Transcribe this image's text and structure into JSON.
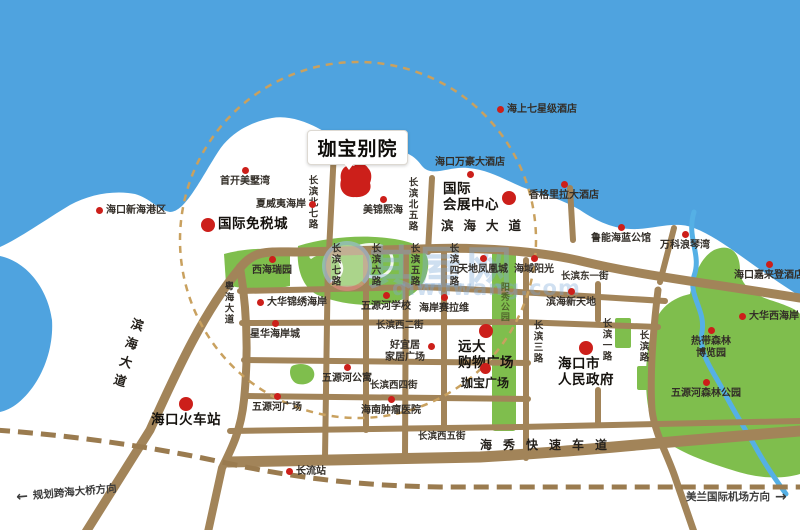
{
  "meta": {
    "map_type": "real-estate location map",
    "project": "珈宝别院"
  },
  "colors": {
    "sea": "#4FA3DF",
    "land": "#FFFFFF",
    "road": "#A28459",
    "railway": "#9A7B4F",
    "green": "#7FBE4D",
    "river": "#55B0E5",
    "marker_red": "#CC1F1A",
    "radius_dash": "#C9A15F",
    "text": "#332E28",
    "watermark": "#7DAAD7"
  },
  "title": {
    "label": "珈宝别院"
  },
  "watermark": {
    "cn": "其屋网",
    "en": "qiwuwang.com"
  },
  "directions": [
    {
      "name": "direction-cross-sea-bridge",
      "arrow": "←",
      "label": "规划跨海大桥方向",
      "x": 16,
      "y": 485,
      "rot": -5,
      "side": "left"
    },
    {
      "name": "direction-meilan-airport",
      "arrow": "→",
      "label": "美兰国际机场方向",
      "x": 686,
      "y": 489,
      "rot": 0,
      "side": "right"
    }
  ],
  "road_labels": [
    {
      "name": "road-binhai-dadao-h",
      "text": "滨海大道",
      "x": 441,
      "y": 219,
      "orient": "h",
      "cls": "road-major"
    },
    {
      "name": "road-binhai-dadao-v",
      "text": "滨海大道",
      "x": 131,
      "y": 318,
      "orient": "v",
      "rot": 17,
      "cls": "road-major-v"
    },
    {
      "name": "road-yuehai-dadao",
      "text": "粤海大道",
      "x": 222,
      "y": 281,
      "orient": "v"
    },
    {
      "name": "road-changbin-north-7",
      "text": "长滨北七路",
      "x": 306,
      "y": 175,
      "orient": "v"
    },
    {
      "name": "road-changbin-north-5",
      "text": "长滨北五路",
      "x": 406,
      "y": 177,
      "orient": "v"
    },
    {
      "name": "road-changbin-7",
      "text": "长滨七路",
      "x": 329,
      "y": 243,
      "orient": "v"
    },
    {
      "name": "road-changbin-6",
      "text": "长滨六路",
      "x": 369,
      "y": 243,
      "orient": "v"
    },
    {
      "name": "road-changbin-5",
      "text": "长滨五路",
      "x": 408,
      "y": 243,
      "orient": "v"
    },
    {
      "name": "road-changbin-4",
      "text": "长滨四路",
      "x": 447,
      "y": 243,
      "orient": "v"
    },
    {
      "name": "road-changbin-3",
      "text": "长滨三路",
      "x": 531,
      "y": 320,
      "orient": "v"
    },
    {
      "name": "road-changbin-1",
      "text": "长滨一路",
      "x": 600,
      "y": 318,
      "orient": "v"
    },
    {
      "name": "road-changbin-lu",
      "text": "长滨路",
      "x": 637,
      "y": 330,
      "orient": "v"
    },
    {
      "name": "road-changbin-east-1st",
      "text": "长滨东一街",
      "x": 561,
      "y": 272,
      "orient": "h"
    },
    {
      "name": "road-changbin-west-2nd",
      "text": "长滨西二街",
      "x": 376,
      "y": 321,
      "orient": "h"
    },
    {
      "name": "road-changbin-west-4th",
      "text": "长滨西四街",
      "x": 370,
      "y": 381,
      "orient": "h"
    },
    {
      "name": "road-changbin-west-5th",
      "text": "长滨西五街",
      "x": 418,
      "y": 432,
      "orient": "h"
    },
    {
      "name": "road-haixiu-expressway",
      "text": "海秀快速车道",
      "x": 480,
      "y": 439,
      "orient": "h",
      "cls": "road-haixiu"
    },
    {
      "name": "park-yangxiu-label",
      "text": "阳秀公园",
      "x": 498,
      "y": 282,
      "orient": "v",
      "cls": "park-label"
    }
  ],
  "pois": [
    {
      "name": "poi-haikou-xinhai-port",
      "lines": [
        "海口新海港区"
      ],
      "dot": "left",
      "x": 96,
      "y": 205,
      "size": "s"
    },
    {
      "name": "poi-shoukai-meishuwan",
      "lines": [
        "首开美墅湾"
      ],
      "dot": "above",
      "x": 245,
      "y": 167,
      "size": "s"
    },
    {
      "name": "poi-xiaweiyi-haian",
      "lines": [
        "夏威夷海岸"
      ],
      "dot": "right",
      "x": 256,
      "y": 199,
      "size": "s"
    },
    {
      "name": "poi-meijin-xihai",
      "lines": [
        "美锦熙海"
      ],
      "dot": "above",
      "x": 383,
      "y": 196,
      "size": "s"
    },
    {
      "name": "poi-haishang-seven-star-hotel",
      "lines": [
        "海上七星级酒店"
      ],
      "dot": "left",
      "x": 497,
      "y": 104,
      "size": "s"
    },
    {
      "name": "poi-haikou-wanhao-hotel",
      "lines": [
        "海口万豪大酒店"
      ],
      "dot": "below",
      "x": 470,
      "y": 157,
      "size": "s"
    },
    {
      "name": "poi-xianggelila-hotel",
      "lines": [
        "香格里拉大酒店"
      ],
      "dot": "above",
      "x": 564,
      "y": 181,
      "size": "s"
    },
    {
      "name": "poi-luneng-hailan-mansion",
      "lines": [
        "鲁能海蓝公馆"
      ],
      "dot": "above",
      "x": 621,
      "y": 224,
      "size": "s"
    },
    {
      "name": "poi-vanke-langqinwan",
      "lines": [
        "万科浪琴湾"
      ],
      "dot": "above",
      "x": 685,
      "y": 231,
      "size": "s"
    },
    {
      "name": "poi-haikou-jialaideng-hotel",
      "lines": [
        "海口嘉来登酒店"
      ],
      "dot": "above",
      "x": 769,
      "y": 261,
      "size": "s"
    },
    {
      "name": "poi-dahua-xihaian",
      "lines": [
        "大华西海岸"
      ],
      "dot": "left",
      "x": 739,
      "y": 311,
      "size": "s"
    },
    {
      "name": "poi-tropical-forest-expo-garden",
      "lines": [
        "热带森林",
        "博览园"
      ],
      "dot": "above",
      "x": 711,
      "y": 327,
      "size": "s"
    },
    {
      "name": "poi-wuyuanhe-forest-park",
      "lines": [
        "五源河森林公园"
      ],
      "dot": "above",
      "x": 706,
      "y": 379,
      "size": "s"
    },
    {
      "name": "poi-xihai-ruiyuan",
      "lines": [
        "西海瑞园"
      ],
      "dot": "above",
      "x": 272,
      "y": 256,
      "size": "s"
    },
    {
      "name": "poi-dahua-jinxiu-haian",
      "lines": [
        "大华锦绣海岸"
      ],
      "dot": "left",
      "x": 257,
      "y": 297,
      "size": "s"
    },
    {
      "name": "poi-xinghua-haian-city",
      "lines": [
        "星华海岸城"
      ],
      "dot": "above",
      "x": 275,
      "y": 320,
      "size": "s"
    },
    {
      "name": "poi-wuyuanhe-school",
      "lines": [
        "五源河学校"
      ],
      "dot": "above",
      "x": 386,
      "y": 292,
      "size": "s"
    },
    {
      "name": "poi-haian-sailawei",
      "lines": [
        "海岸赛拉维"
      ],
      "dot": "above",
      "x": 444,
      "y": 294,
      "size": "s"
    },
    {
      "name": "poi-tiandi-phoenix-city",
      "lines": [
        "天地凤凰城"
      ],
      "dot": "above",
      "x": 483,
      "y": 255,
      "size": "s"
    },
    {
      "name": "poi-haiyu-yangguang",
      "lines": [
        "海域阳光"
      ],
      "dot": "above",
      "x": 534,
      "y": 255,
      "size": "s"
    },
    {
      "name": "poi-binhai-xintiandi",
      "lines": [
        "滨海新天地"
      ],
      "dot": "above",
      "x": 571,
      "y": 288,
      "size": "s"
    },
    {
      "name": "poi-haoyiju-home-plaza",
      "lines": [
        "好宜居",
        "家居广场"
      ],
      "dot": "right-top",
      "x": 385,
      "y": 340,
      "size": "s"
    },
    {
      "name": "poi-wuyuanhe-apartment",
      "lines": [
        "五源河公寓"
      ],
      "dot": "above",
      "x": 347,
      "y": 364,
      "size": "s"
    },
    {
      "name": "poi-wuyuanhe-plaza",
      "lines": [
        "五源河广场"
      ],
      "dot": "above",
      "x": 277,
      "y": 393,
      "size": "s"
    },
    {
      "name": "poi-hainan-tumor-hospital",
      "lines": [
        "海南肿瘤医院"
      ],
      "dot": "above",
      "x": 391,
      "y": 396,
      "size": "s"
    },
    {
      "name": "poi-changliu-station",
      "lines": [
        "长流站"
      ],
      "dot": "left",
      "x": 286,
      "y": 466,
      "size": "s"
    },
    {
      "name": "poi-international-duty-free-city",
      "lines": [
        "国际免税城"
      ],
      "dot": "left",
      "x": 201,
      "y": 217,
      "size": "b"
    },
    {
      "name": "poi-international-exhibition-center",
      "lines": [
        "国际",
        "会展中心"
      ],
      "dot": "right",
      "x": 443,
      "y": 182,
      "size": "b",
      "align": "left"
    },
    {
      "name": "poi-haikou-railway-station",
      "lines": [
        "海口火车站"
      ],
      "dot": "above",
      "x": 186,
      "y": 397,
      "size": "b"
    },
    {
      "name": "poi-yuanda-shopping-plaza",
      "lines": [
        "远大",
        "购物广场"
      ],
      "dot": "above",
      "x": 486,
      "y": 324,
      "size": "b",
      "align": "left"
    },
    {
      "name": "poi-haikou-city-government",
      "lines": [
        "海口市",
        "人民政府"
      ],
      "dot": "above",
      "x": 586,
      "y": 341,
      "size": "b",
      "align": "left"
    },
    {
      "name": "poi-jiabao-plaza",
      "lines": [
        "珈宝广场"
      ],
      "dot": "above",
      "x": 485,
      "y": 363,
      "size": "m"
    }
  ]
}
